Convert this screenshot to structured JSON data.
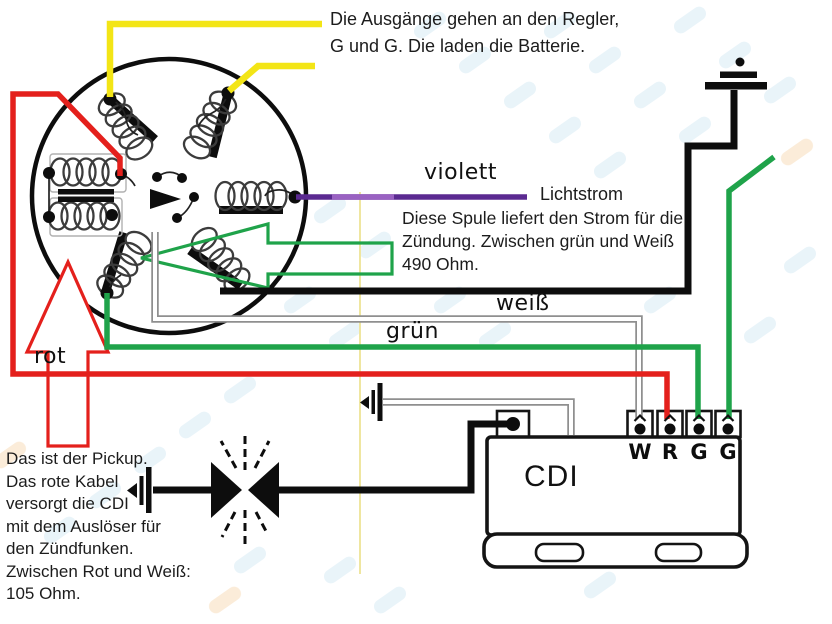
{
  "colors": {
    "yellow": "#f3e516",
    "red": "#e4201c",
    "green": "#1fa34a",
    "violet": "#5b2a91",
    "black": "#0d0d0d",
    "grey": "#8f8f8f",
    "watermark_blue": "#cfe6f2",
    "watermark_orange": "#f7ddbb"
  },
  "annotations": {
    "regler_line1": "Die Ausgänge gehen an den Regler,",
    "regler_line2": "G und G. Die laden die Batterie.",
    "lichtstrom": "Lichtstrom",
    "spule_line1": "Diese Spule liefert den Strom für die",
    "spule_line2": "Zündung. Zwischen grün und Weiß",
    "spule_line3": "490 Ohm.",
    "pickup_lines": [
      "Das ist der Pickup.",
      "Das rote Kabel",
      "versorgt die CDI",
      "mit dem Auslöser für",
      "den Zündfunken.",
      "Zwischen Rot und Weiß:",
      "105 Ohm."
    ]
  },
  "wire_labels": {
    "violett": "violett",
    "weiss": "weiß",
    "gruen": "grün",
    "rot": "rot"
  },
  "cdi": {
    "label": "CDI",
    "terminals": [
      "W",
      "R",
      "G",
      "G"
    ]
  }
}
